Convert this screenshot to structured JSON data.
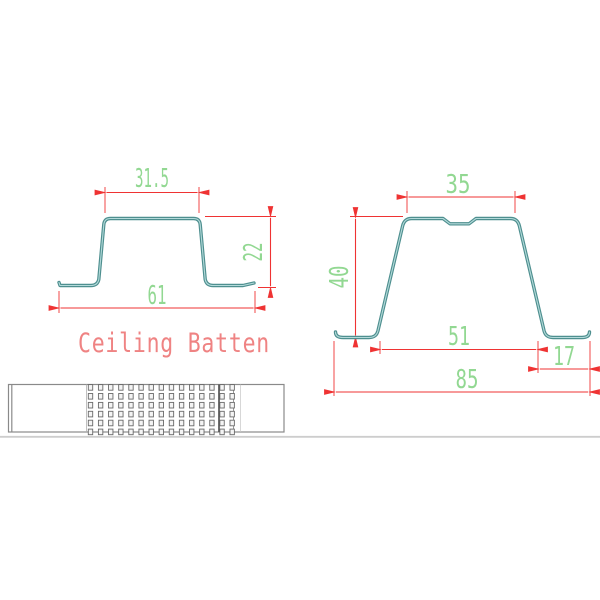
{
  "drawing": {
    "left_profile": {
      "label": "Ceiling Batten",
      "dims": {
        "top_width": "31.5",
        "height": "22",
        "bottom_width": "61"
      }
    },
    "right_profile": {
      "dims": {
        "top_width": "35",
        "height": "40",
        "bottom_inner_width": "51",
        "flange_width": "17",
        "total_width": "85"
      }
    },
    "strip": {
      "perforation_rows": 6,
      "perforation_cols": 15
    }
  },
  "colors": {
    "profile": "#4e8f8f",
    "profile_core": "#bfe2e2",
    "dimension": "#ef3333",
    "dim_text": "#92d892",
    "label_text": "#ef8383",
    "strip_line": "#8a8a8a",
    "strip_dark": "#4a4a4a",
    "strip_light": "#cdcdcd",
    "slot_stroke": "#6a6a6a",
    "slot_fill": "#f4f4f4"
  }
}
